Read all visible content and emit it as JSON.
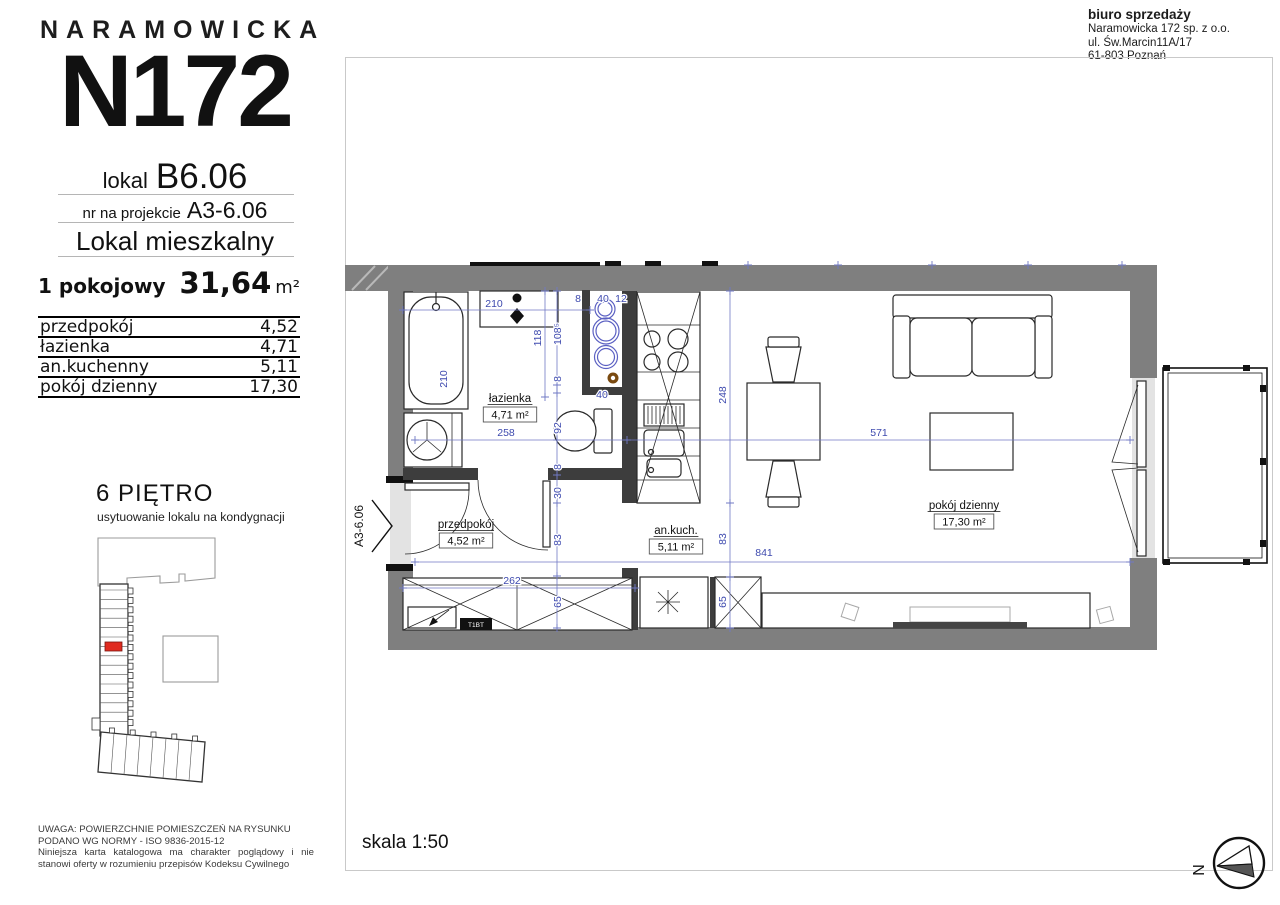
{
  "colors": {
    "wall_gray": "#7f7f7f",
    "dark_wall": "#3d3d3d",
    "dim_blue": "#3d49ae",
    "dim_line_blue": "#7079c4",
    "highlight_red": "#e02b20",
    "brown": "#7a4a10"
  },
  "brand": {
    "street": "NARAMOWICKA",
    "building": "N172"
  },
  "unit": {
    "lokal_label": "lokal",
    "lokal_number": "B6.06",
    "project_label": "nr na projekcie",
    "project_number": "A3-6.06",
    "type": "Lokal mieszkalny"
  },
  "summary": {
    "layout": "1 pokojowy",
    "area": "31,64",
    "area_unit": "m²"
  },
  "rooms_table": [
    {
      "name": "przedpokój",
      "area": "4,52"
    },
    {
      "name": "łazienka",
      "area": "4,71"
    },
    {
      "name": "an.kuchenny",
      "area": "5,11"
    },
    {
      "name": "pokój dzienny",
      "area": "17,30"
    }
  ],
  "floor_info": {
    "title": "6 PIĘTRO",
    "subtitle": "usytuowanie lokalu na kondygnacji"
  },
  "sales_office": {
    "title": "biuro sprzedaży",
    "company": "Naramowicka 172 sp. z o.o.",
    "street": "ul. Św.Marcin11A/17",
    "city": "61-803 Poznań"
  },
  "disclaimer": {
    "line1": "UWAGA: POWIERZCHNIE POMIESZCZEŃ NA RYSUNKU",
    "line2": "PODANO WG NORMY - ISO 9836-2015-12",
    "note": "Niniejsza karta katalogowa ma charakter poglądowy i nie stanowi oferty w rozumieniu przepisów Kodeksu Cywilnego"
  },
  "scale": {
    "label": "skala 1:50"
  },
  "compass": {
    "letter": "N"
  },
  "plan": {
    "unit_ref": "A3-6.06",
    "wardrobe_tag": "T1BT",
    "rooms": [
      {
        "name": "łazienka",
        "area": "4,71 m²",
        "x": 510,
        "y": 402
      },
      {
        "name": "przedpokój",
        "area": "4,52 m²",
        "x": 466,
        "y": 528
      },
      {
        "name": "an.kuch.",
        "area": "5,11 m²",
        "x": 676,
        "y": 534
      },
      {
        "name": "pokój dzienny",
        "area": "17,30 m²",
        "x": 964,
        "y": 509
      }
    ],
    "dims": [
      {
        "t": "210",
        "x": 494,
        "y": 307,
        "r": 0
      },
      {
        "t": "8",
        "x": 578,
        "y": 302,
        "r": 0
      },
      {
        "t": "40",
        "x": 603,
        "y": 302,
        "r": 0
      },
      {
        "t": "12",
        "x": 621,
        "y": 302,
        "r": 0
      },
      {
        "t": "118",
        "x": 541,
        "y": 338,
        "r": -90
      },
      {
        "t": "108⁵",
        "x": 561,
        "y": 334,
        "r": -90
      },
      {
        "t": "8",
        "x": 561,
        "y": 379,
        "r": -90
      },
      {
        "t": "210",
        "x": 447,
        "y": 379,
        "r": -90
      },
      {
        "t": "40",
        "x": 602,
        "y": 398,
        "r": 0
      },
      {
        "t": "92",
        "x": 561,
        "y": 428,
        "r": -90
      },
      {
        "t": "258",
        "x": 506,
        "y": 436,
        "r": 0
      },
      {
        "t": "571",
        "x": 879,
        "y": 436,
        "r": 0
      },
      {
        "t": "248",
        "x": 726,
        "y": 395,
        "r": -90
      },
      {
        "t": "8",
        "x": 561,
        "y": 467,
        "r": -90
      },
      {
        "t": "30",
        "x": 561,
        "y": 493,
        "r": -90
      },
      {
        "t": "83",
        "x": 561,
        "y": 540,
        "r": -90
      },
      {
        "t": "83",
        "x": 726,
        "y": 539,
        "r": -90
      },
      {
        "t": "262",
        "x": 512,
        "y": 584,
        "r": 0
      },
      {
        "t": "65",
        "x": 561,
        "y": 602,
        "r": -90
      },
      {
        "t": "65",
        "x": 726,
        "y": 602,
        "r": -90
      },
      {
        "t": "841",
        "x": 764,
        "y": 556,
        "r": 0
      }
    ]
  }
}
